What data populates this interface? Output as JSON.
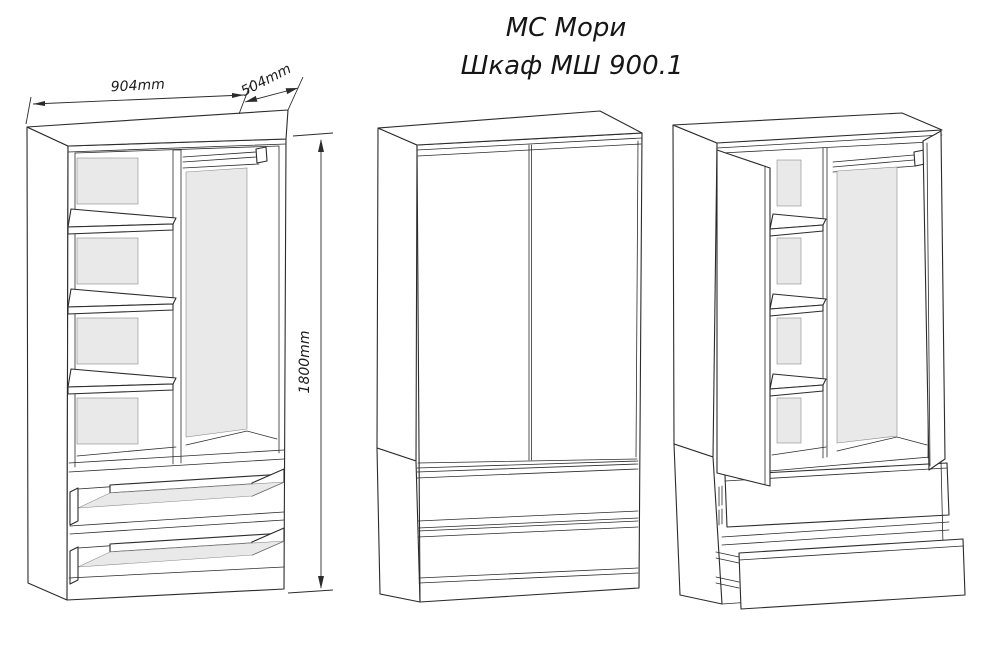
{
  "title": {
    "line1": "МС Мори",
    "line2": "Шкаф МШ 900.1"
  },
  "dimensions": {
    "width_label": "904mm",
    "depth_label": "504mm",
    "height_label": "1800mm"
  },
  "colors": {
    "line": "#2b2b2b",
    "panel_fill": "#e9e9e9",
    "background": "#ffffff"
  }
}
